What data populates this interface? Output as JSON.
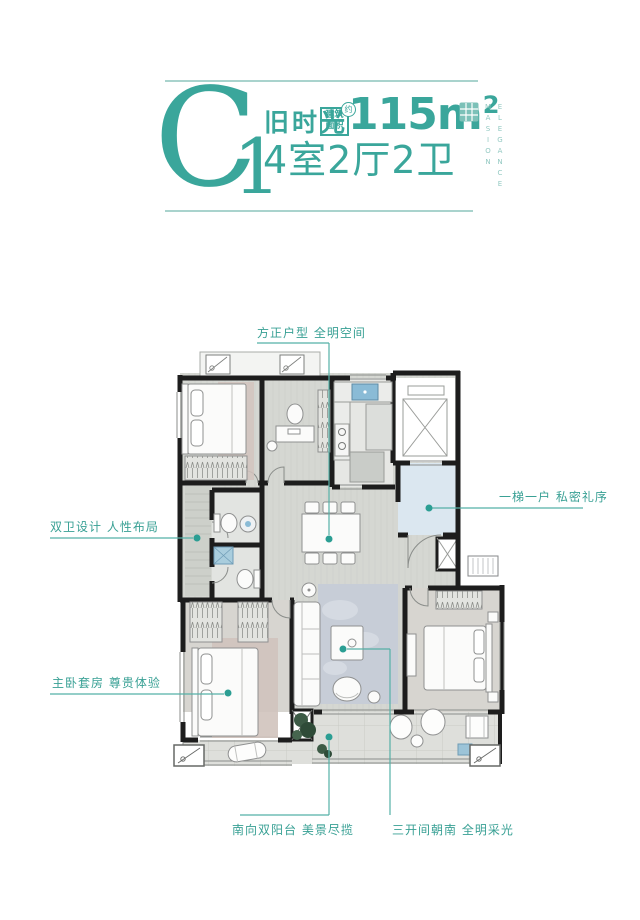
{
  "header": {
    "unit_code": "C",
    "unit_number": "1",
    "series_name": "旧时光",
    "area_label_line1": "建筑",
    "area_label_line2": "面积",
    "area_approx": "约",
    "area_value": "115m",
    "area_sup": "2",
    "layout": "4室2厅2卫",
    "brand_line1": "ELEGANCE",
    "brand_line2": "MASION"
  },
  "annotations": {
    "top": "方正户型 全明空间",
    "right": "一梯一户 私密礼序",
    "left_upper": "双卫设计 人性布局",
    "left_lower": "主卧套房 尊贵体验",
    "bottom_left": "南向双阳台 美景尽揽",
    "bottom_right": "三开间朝南 全明采光"
  },
  "colors": {
    "accent_teal": "#3aa69b",
    "divider_teal": "#a9d3cd",
    "wall_black": "#1d1d1d",
    "entry_hall_blue": "#dbe7f0",
    "fixture_blue": "#8abbd6"
  }
}
